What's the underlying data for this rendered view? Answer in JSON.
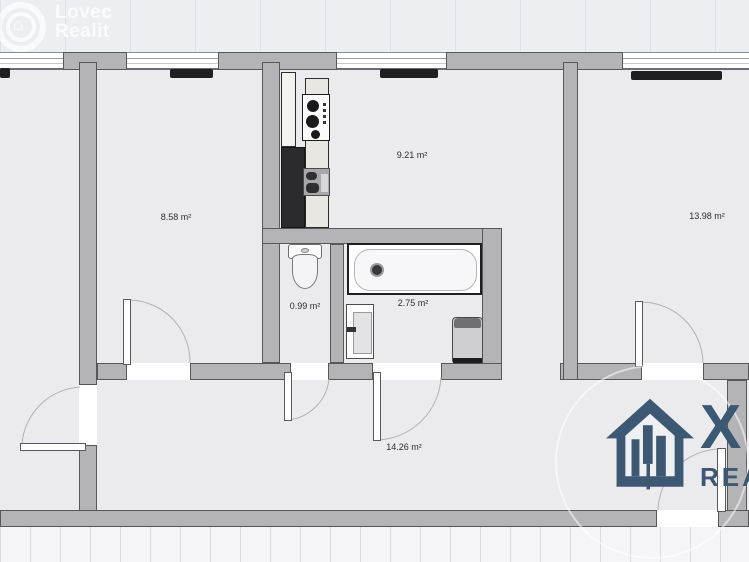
{
  "watermark": {
    "line1": "Lovec",
    "line2": "Realit",
    "house_glyph": "⌂"
  },
  "logo": {
    "big_letter": "X",
    "sub_text": "REA",
    "color": "#3d5873"
  },
  "rooms": [
    {
      "name": "bedroom-left",
      "area_label": "8.58 m²"
    },
    {
      "name": "kitchen",
      "area_label": "9.21 m²"
    },
    {
      "name": "bedroom-right",
      "area_label": "13.98 m²"
    },
    {
      "name": "wc",
      "area_label": "0.99 m²"
    },
    {
      "name": "bathroom",
      "area_label": "2.75 m²"
    },
    {
      "name": "hallway",
      "area_label": "14.26 m²"
    }
  ],
  "colors": {
    "wall": "#b4b4b6",
    "room_interior": "#ebebed",
    "background": "#eceef2",
    "radiator": "#1f1f21",
    "logo_blue": "#3d5873"
  },
  "fixtures": [
    "toilet",
    "bathtub",
    "washbasin",
    "water-heater",
    "kitchen-counter",
    "stove",
    "kitchen-sink",
    "tall-cabinet",
    "fridge-cabinet",
    "radiator"
  ]
}
